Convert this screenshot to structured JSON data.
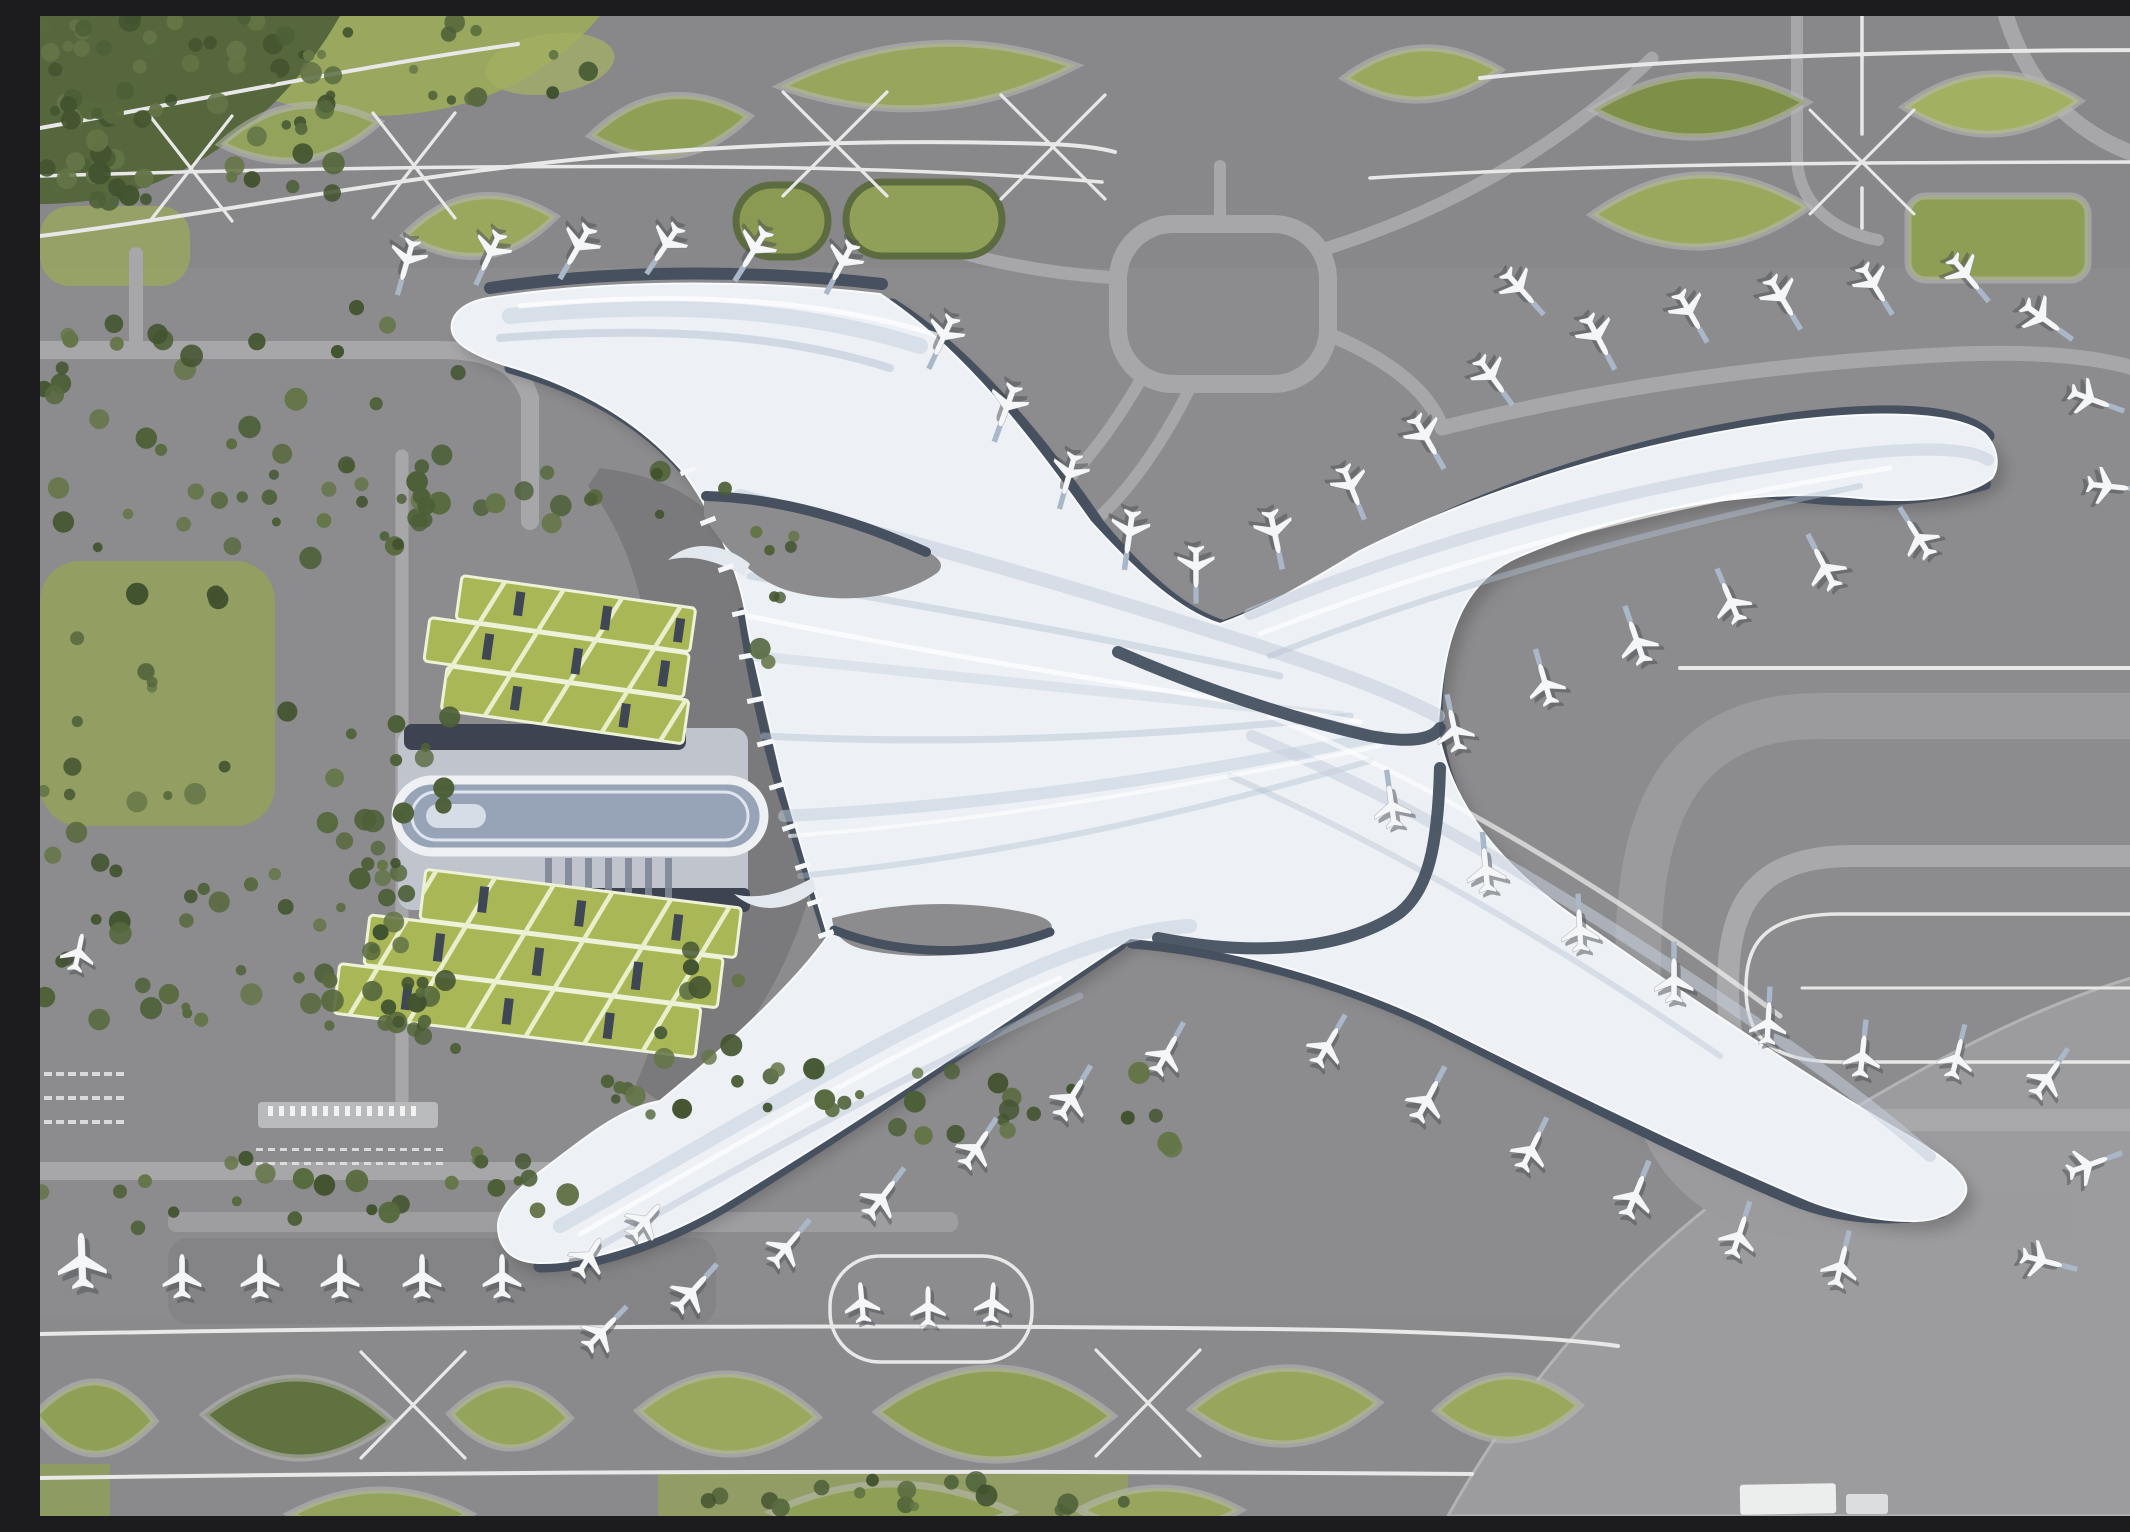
{
  "meta": {
    "scene": "airport-terminal-aerial-render",
    "description": "Aerial rendering of a flowing X-shaped airport terminal with curved piers, docked aircraft, taxiway loops, green-roof parking garages and a ground transport centre",
    "no_visible_text": true
  },
  "palette": {
    "tarmac": "#8c8c8e",
    "tarmac_band": "#848487",
    "apron_light": "#9c9c9e",
    "taxi_line": "#e8e8e8",
    "road": "#a7a7a9",
    "forecourt_dark": "#7a7a7c",
    "grass": "#97a55c",
    "grass_dark": "#5f7240",
    "tree_1": "#4c5f37",
    "tree_2": "#57693d",
    "tree_3": "#42532f",
    "tree_4": "#647547",
    "garage_green": "#a9b756",
    "garage_line": "#e9eecb",
    "garage_slot": "#3f4654",
    "roof_white": "#edf0f5",
    "roof_shade": "#c2cddb",
    "roof_shade2": "#b4c1d2",
    "apron_dark": "#46505f",
    "plane_white": "#f5f6f8",
    "plane_shadow": "#4a4d52",
    "bridge_blue": "#a9b7c9",
    "gtc_slab": "#c0c5cd",
    "gtc_dark": "#3d4350",
    "oval_deck": "#97a3b7"
  },
  "stats": {
    "airplanes": 65,
    "parking_garages": 2,
    "terminal_piers": 4,
    "green_islands": 21,
    "toll_booths": 14
  },
  "scene": {
    "planes": [
      [
        368,
        242,
        196,
        1.1,
        1
      ],
      [
        452,
        234,
        205,
        1.1,
        1
      ],
      [
        540,
        228,
        210,
        1.15,
        1
      ],
      [
        628,
        226,
        214,
        1.1,
        1
      ],
      [
        716,
        231,
        212,
        1.15,
        1
      ],
      [
        804,
        244,
        208,
        1.1,
        1
      ],
      [
        905,
        318,
        205,
        1.1,
        1
      ],
      [
        968,
        388,
        200,
        1.15,
        1
      ],
      [
        1030,
        456,
        196,
        1.1,
        1
      ],
      [
        1090,
        514,
        188,
        1.15,
        1
      ],
      [
        1156,
        549,
        180,
        1.1,
        1
      ],
      [
        1234,
        514,
        168,
        1.15,
        1
      ],
      [
        1310,
        468,
        158,
        1.1,
        1
      ],
      [
        1384,
        418,
        150,
        1.15,
        1
      ],
      [
        1450,
        358,
        144,
        1.1,
        1
      ],
      [
        1478,
        270,
        138,
        1.1,
        1
      ],
      [
        1556,
        318,
        152,
        1.15,
        1
      ],
      [
        1648,
        293,
        150,
        1.1,
        1
      ],
      [
        1740,
        279,
        149,
        1.15,
        1
      ],
      [
        1832,
        266,
        148,
        1.1,
        1
      ],
      [
        1924,
        256,
        140,
        1.1,
        1
      ],
      [
        2000,
        300,
        126,
        1.15,
        1
      ],
      [
        2048,
        382,
        110,
        1.1,
        1
      ],
      [
        2066,
        470,
        96,
        1.1,
        1
      ],
      [
        1880,
        524,
        328,
        1.1,
        1
      ],
      [
        1786,
        554,
        333,
        1.15,
        1
      ],
      [
        1692,
        588,
        337,
        1.1,
        1
      ],
      [
        1598,
        628,
        341,
        1.15,
        1
      ],
      [
        1506,
        670,
        344,
        1.1,
        1
      ],
      [
        1415,
        716,
        348,
        1.1,
        1
      ],
      [
        1352,
        792,
        352,
        1.1,
        1
      ],
      [
        1446,
        856,
        355,
        1.15,
        1
      ],
      [
        1540,
        916,
        357,
        1.1,
        1
      ],
      [
        1634,
        966,
        0,
        1.15,
        1
      ],
      [
        1728,
        1009,
        3,
        1.1,
        1
      ],
      [
        1822,
        1042,
        6,
        1.1,
        1
      ],
      [
        1916,
        1044,
        14,
        1.05,
        1
      ],
      [
        1286,
        1032,
        30,
        1.1,
        1
      ],
      [
        1386,
        1086,
        28,
        1.15,
        1
      ],
      [
        1490,
        1136,
        26,
        1.1,
        1
      ],
      [
        1594,
        1182,
        22,
        1.15,
        1
      ],
      [
        1698,
        1222,
        18,
        1.1,
        1
      ],
      [
        1800,
        1252,
        14,
        1.1,
        1
      ],
      [
        2006,
        1064,
        35,
        1.1,
        1
      ],
      [
        2046,
        1150,
        70,
        1.1,
        1
      ],
      [
        2000,
        1244,
        104,
        1.1,
        1
      ],
      [
        560,
        1318,
        44,
        1.1,
        1
      ],
      [
        650,
        1278,
        42,
        1.15,
        1
      ],
      [
        745,
        1233,
        40,
        1.1,
        1
      ],
      [
        840,
        1184,
        37,
        1.15,
        1
      ],
      [
        935,
        1134,
        34,
        1.1,
        1
      ],
      [
        1030,
        1084,
        31,
        1.15,
        1
      ],
      [
        1125,
        1040,
        29,
        1.1,
        1
      ],
      [
        42,
        1247,
        358,
        1.45,
        0
      ],
      [
        142,
        1262,
        0,
        1.15,
        0
      ],
      [
        220,
        1262,
        0,
        1.15,
        0
      ],
      [
        300,
        1262,
        0,
        1.15,
        0
      ],
      [
        382,
        1262,
        0,
        1.15,
        0
      ],
      [
        462,
        1262,
        0,
        1.15,
        0
      ],
      [
        548,
        1242,
        32,
        1.1,
        0
      ],
      [
        604,
        1206,
        42,
        1.1,
        0
      ],
      [
        822,
        1288,
        355,
        1.05,
        0
      ],
      [
        888,
        1292,
        0,
        1.05,
        0
      ],
      [
        952,
        1288,
        4,
        1.05,
        0
      ],
      [
        38,
        938,
        12,
        1.0,
        0
      ]
    ],
    "tree_clusters": [
      [
        0,
        0,
        300,
        185,
        60,
        1
      ],
      [
        250,
        0,
        300,
        85,
        16,
        2
      ],
      [
        0,
        80,
        115,
        110,
        18,
        3
      ],
      [
        0,
        285,
        360,
        270,
        46,
        4
      ],
      [
        0,
        560,
        240,
        250,
        15,
        5
      ],
      [
        0,
        815,
        360,
        200,
        40,
        6
      ],
      [
        325,
        345,
        95,
        720,
        30,
        7
      ],
      [
        380,
        450,
        320,
        58,
        16,
        8
      ],
      [
        245,
        695,
        115,
        200,
        12,
        9
      ],
      [
        618,
        905,
        105,
        150,
        9,
        10
      ],
      [
        555,
        1048,
        585,
        88,
        34,
        11
      ],
      [
        0,
        1128,
        530,
        88,
        26,
        12
      ],
      [
        352,
        900,
        55,
        115,
        7,
        13
      ],
      [
        700,
        508,
        55,
        170,
        8,
        14
      ],
      [
        618,
        1458,
        470,
        40,
        18,
        15
      ]
    ],
    "islands": [
      {
        "t": "lens",
        "x": 260,
        "y": 117,
        "rx": 80,
        "ry": 27,
        "rot": -8,
        "f": "#93a35c"
      },
      {
        "t": "lens",
        "x": 440,
        "y": 210,
        "rx": 76,
        "ry": 30,
        "rot": -7,
        "f": "#9aa85e"
      },
      {
        "t": "lens",
        "x": 630,
        "y": 110,
        "rx": 80,
        "ry": 30,
        "rot": -7,
        "f": "#8f9f56"
      },
      {
        "t": "lens",
        "x": 888,
        "y": 60,
        "rx": 148,
        "ry": 32,
        "rot": -4,
        "f": "#97a65c"
      },
      {
        "t": "stad",
        "x": 742,
        "y": 205,
        "rx": 46,
        "ry": 36,
        "rot": 0,
        "f": "#8a9a52"
      },
      {
        "t": "stad",
        "x": 884,
        "y": 203,
        "rx": 78,
        "ry": 37,
        "rot": 0,
        "f": "#90a058"
      },
      {
        "t": "lens",
        "x": 1382,
        "y": 58,
        "rx": 78,
        "ry": 26,
        "rot": -3,
        "f": "#9aa85e"
      },
      {
        "t": "lens",
        "x": 1660,
        "y": 90,
        "rx": 107,
        "ry": 31,
        "rot": -2,
        "f": "#7e9048"
      },
      {
        "t": "lens",
        "x": 1952,
        "y": 88,
        "rx": 88,
        "ry": 30,
        "rot": -2,
        "f": "#a2b062"
      },
      {
        "t": "lens",
        "x": 1660,
        "y": 195,
        "rx": 108,
        "ry": 36,
        "rot": -2,
        "f": "#9aa85e"
      },
      {
        "t": "rrect",
        "x": 1958,
        "y": 222,
        "rx": 90,
        "ry": 42,
        "rot": 0,
        "f": "#8e9e54"
      },
      {
        "t": "lens",
        "x": 55,
        "y": 1402,
        "rx": 60,
        "ry": 36,
        "rot": 3,
        "f": "#8f9f56"
      },
      {
        "t": "lens",
        "x": 258,
        "y": 1402,
        "rx": 94,
        "ry": 40,
        "rot": 2,
        "f": "#5f7240"
      },
      {
        "t": "lens",
        "x": 470,
        "y": 1400,
        "rx": 60,
        "ry": 32,
        "rot": 2,
        "f": "#94a45a"
      },
      {
        "t": "lens",
        "x": 688,
        "y": 1398,
        "rx": 90,
        "ry": 40,
        "rot": 2,
        "f": "#9aa85e"
      },
      {
        "t": "lens",
        "x": 955,
        "y": 1398,
        "rx": 118,
        "ry": 46,
        "rot": 1,
        "f": "#8f9f56"
      },
      {
        "t": "lens",
        "x": 1245,
        "y": 1390,
        "rx": 94,
        "ry": 38,
        "rot": -2,
        "f": "#97a65c"
      },
      {
        "t": "lens",
        "x": 1468,
        "y": 1392,
        "rx": 72,
        "ry": 32,
        "rot": -2,
        "f": "#9aa85e"
      },
      {
        "t": "lens",
        "x": 340,
        "y": 1498,
        "rx": 90,
        "ry": 24,
        "rot": 0,
        "f": "#93a35c"
      },
      {
        "t": "lens",
        "x": 852,
        "y": 1496,
        "rx": 120,
        "ry": 28,
        "rot": 0,
        "f": "#8f9f56"
      },
      {
        "t": "lens",
        "x": 1120,
        "y": 1494,
        "rx": 80,
        "ry": 22,
        "rot": 0,
        "f": "#97a65c"
      }
    ],
    "scallop_ticks": [
      [
        648,
        455
      ],
      [
        668,
        505
      ],
      [
        686,
        552
      ],
      [
        700,
        597
      ],
      [
        707,
        640
      ],
      [
        715,
        684
      ],
      [
        725,
        727
      ],
      [
        737,
        770
      ],
      [
        750,
        811
      ],
      [
        763,
        850
      ],
      [
        775,
        886
      ],
      [
        786,
        918
      ]
    ],
    "dash_lots": [
      {
        "x": 4,
        "y": 1056,
        "cols": 7,
        "rows": 3,
        "dx": 12,
        "dy": 24,
        "w": 8,
        "h": 4
      },
      {
        "x": 216,
        "y": 1132,
        "cols": 16,
        "rows": 2,
        "dx": 12,
        "dy": 14,
        "w": 7,
        "h": 3
      }
    ],
    "toll": {
      "x": 228,
      "y": 1090,
      "n": 14,
      "dx": 11,
      "w": 5,
      "h": 10
    }
  }
}
